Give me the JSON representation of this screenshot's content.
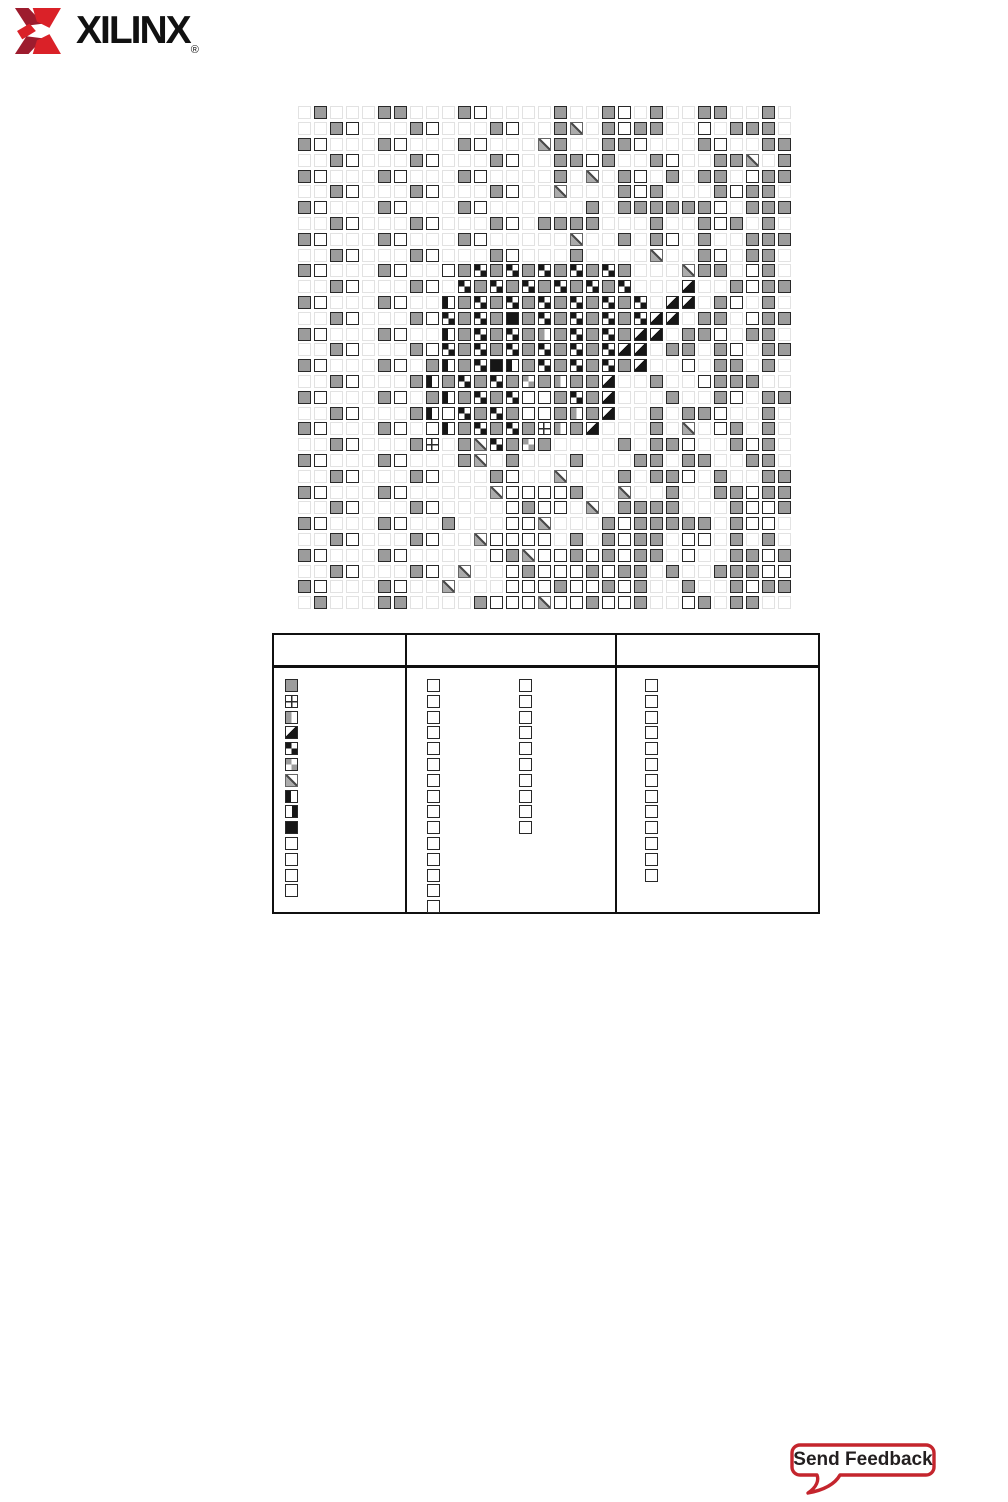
{
  "logo": {
    "brand": "XILINX",
    "registered": "®",
    "emblem_dark": "#9d1c2e",
    "emblem_red": "#da2128"
  },
  "grid": {
    "columns": 31,
    "rows": 32,
    "cell_px": 16,
    "cell_codes": {
      ".": "empty",
      "g": "gray",
      "w": "white",
      "s": "slash",
      "d": "diag-black",
      "k": "checker-black",
      "c": "checker-gray",
      "b": "black",
      "l": "half-black-left",
      "r": "half-black-right",
      "v": "half-gray-left",
      "x": "quad-cross"
    },
    "rows_map": [
      ".g...gg...gw....g..gw.g..gg..g.",
      "..gw...gw...gw..gs.gwgg..w.ggg.",
      "gw...gw...gw...sg..ggw...gw..gg",
      "..gw...gw...gw..ggwg..gw..ggs.g",
      "gw...gw...gw....g.s.gw.g.gg.wgg",
      "..gw...gw...gw..s...gwg...gwgg.",
      "gw...gw...gw......g.ggggggw.ggg",
      "..gw...gw...gw.gggg...g..gwg.g.",
      "gw...gw...gw.....s..g.gw.g..ggg",
      "..gw...gw...gw...g....s..gw.gg.",
      "gw...gw..wgkgkgkgkgkg...sgg.wg.",
      "..gw...gw.kgkgkgkgkgk...d..gwgg",
      "gw...gw..lgkgkgkgkgkgk.dd.gw.g.",
      "..gw...gwkgkgbgkgkgkgkdd.gg.wgg",
      "gw...gw..lgkgkgvgkgkgdd.ggw.gg.",
      "..gw...gwkgkgkgkgkgkdd.gg.gw.gg",
      "gw...gw.glgkblgkgkgkgd..w.gg.g.",
      "..gw...glgkgkgcgvggd..g..wggg..",
      "gw...gw.glgkgkwwgkgd...g..gw.gg",
      "..gw...glwkgkgwwgvgd..g.ggw..g.",
      "gw...gw.wlgkgkgxvgd...g.s.wg.g.",
      "..gw...gx.gskgcg....g.ggw..gwg.",
      "gw...gw...gs.g...g...gg.gg..gg.",
      "..gw...gw...gw..s...g.ggw.g..gg",
      "gw...gw.....swwwwg..s..g..ggwgg",
      "..gw...gw....wgww.s.gggg...gwwg",
      "gw...gw..g...wws...gwggggg.gww.",
      "..gw...gw..swwww.g.gwgg.ww.g.g.",
      "gw...gw.....wgswwgwgwgg.w..ggwg",
      "..gw...gw.s..wgwwwgwgg.g..gggww",
      "gw...gw..s...wwwgwwgwg..g..gwgg",
      ".g...gg....gwwwswwgwwg..wg.gg.."
    ]
  },
  "legend": {
    "header_labels": [
      "",
      "",
      ""
    ],
    "column1_symbols": [
      "gray",
      "quad-cross",
      "half-gray-left",
      "diag-black",
      "checker-black",
      "checker-gray",
      "slash",
      "half-black-left",
      "half-black-right",
      "black",
      "white",
      "white",
      "white",
      "white"
    ],
    "column2_symbols_a": [
      "white",
      "white",
      "white",
      "white",
      "white",
      "white",
      "white",
      "white",
      "white",
      "white",
      "white",
      "white",
      "white",
      "white",
      "white"
    ],
    "column2_symbols_b": [
      "white",
      "white",
      "white",
      "white",
      "white",
      "white",
      "white",
      "white",
      "white",
      "white"
    ],
    "column3_symbols": [
      "white",
      "white",
      "white",
      "white",
      "white",
      "white",
      "white",
      "white",
      "white",
      "white",
      "white",
      "white",
      "white"
    ]
  },
  "feedback": {
    "label": "Send Feedback",
    "border_color": "#c4252d",
    "text_color": "#231f20"
  }
}
